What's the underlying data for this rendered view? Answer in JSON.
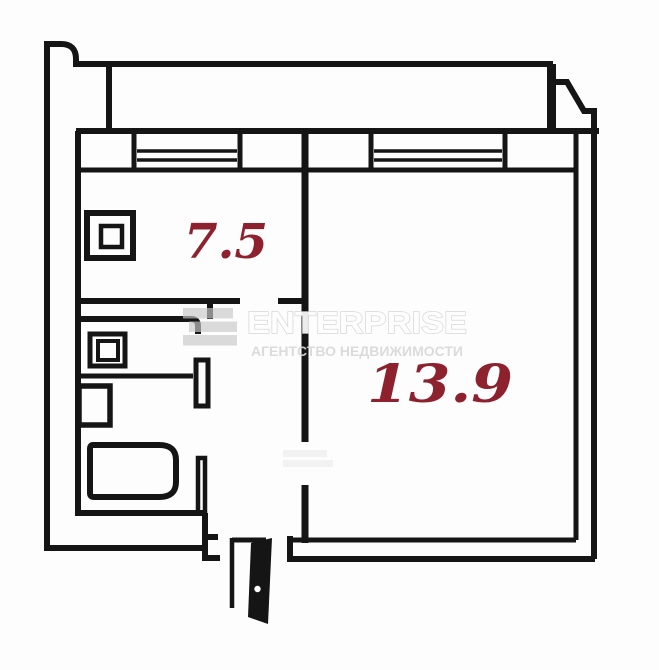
{
  "floor_plan": {
    "rooms": [
      {
        "name": "kitchen",
        "area": "7.5"
      },
      {
        "name": "living-room",
        "area": "13.9"
      }
    ],
    "watermark": {
      "brand": "ENTERPRISE",
      "tagline": "АГЕНТСТВО НЕДВИЖИМОСТИ"
    },
    "colors": {
      "walls": "#151515",
      "area_labels": "#8e212e",
      "watermark_gray": "#d9d9d9",
      "background": "#fdfdfd"
    }
  }
}
